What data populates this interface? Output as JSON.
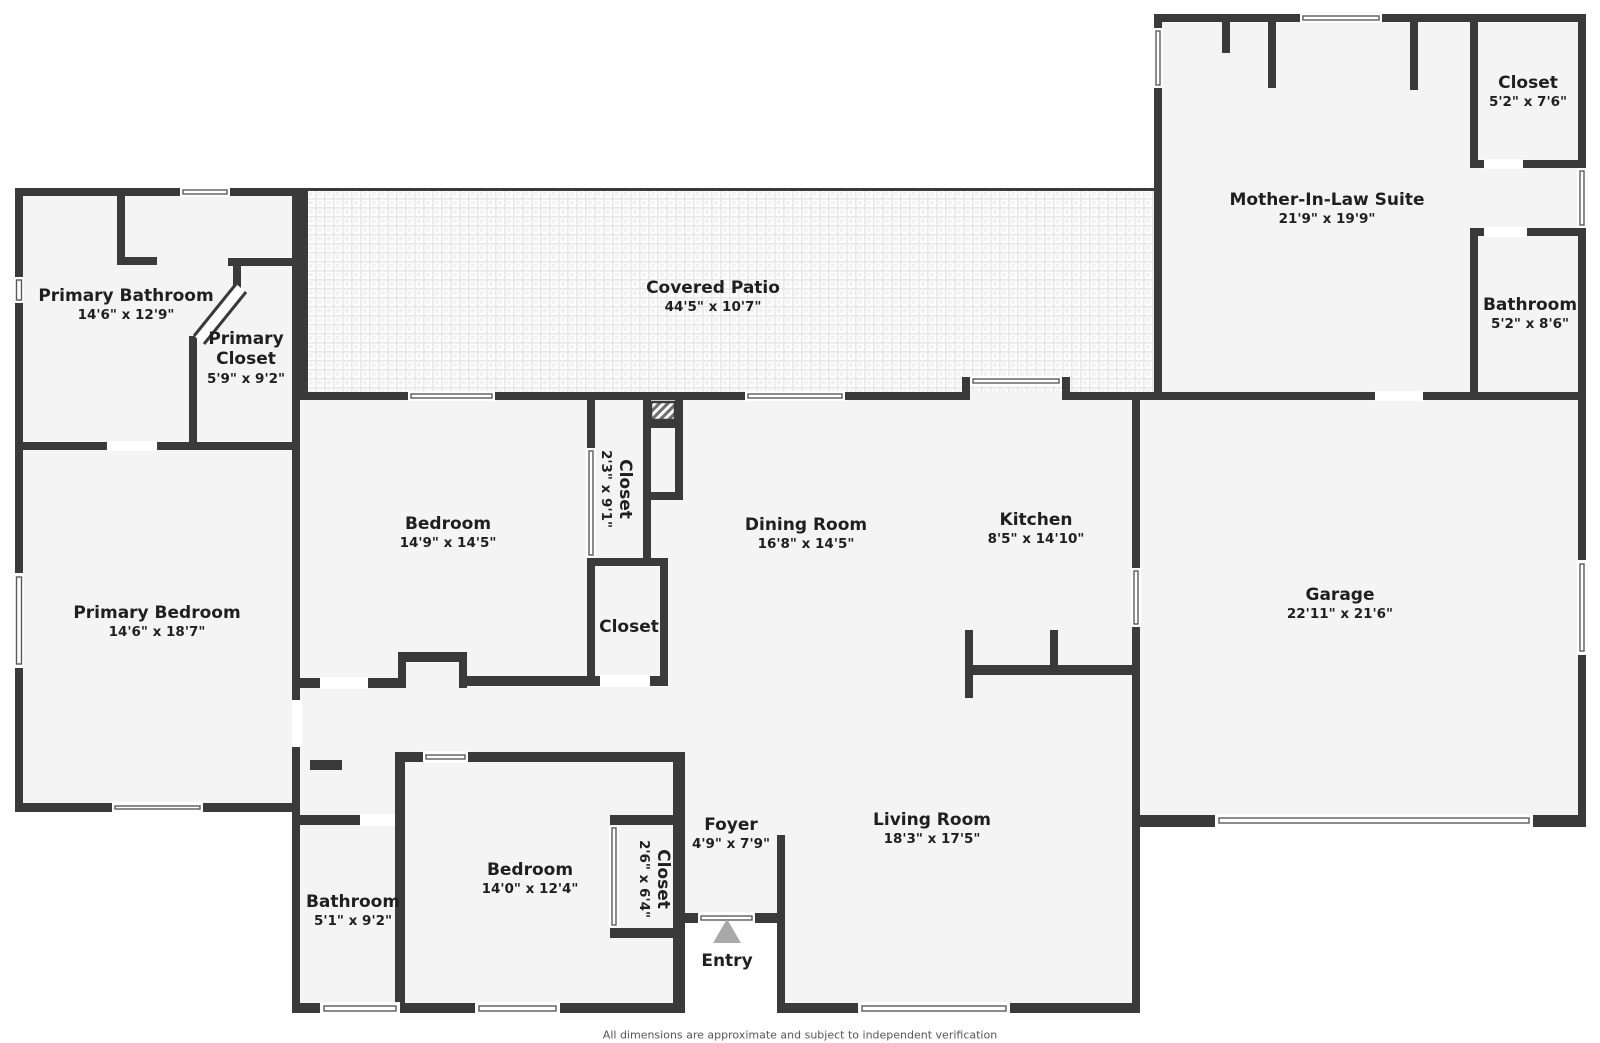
{
  "rooms": {
    "primary_bathroom": {
      "name": "Primary Bathroom",
      "dims": "14'6\" x 12'9\""
    },
    "primary_closet": {
      "name": "Primary Closet",
      "dims": "5'9\" x 9'2\""
    },
    "primary_bedroom": {
      "name": "Primary Bedroom",
      "dims": "14'6\" x 18'7\""
    },
    "bedroom_mid": {
      "name": "Bedroom",
      "dims": "14'9\" x 14'5\""
    },
    "closet_hall": {
      "name": "Closet",
      "dims": "2'3\" x 9'1\""
    },
    "closet_mid": {
      "name": "Closet"
    },
    "dining_room": {
      "name": "Dining Room",
      "dims": "16'8\" x 14'5\""
    },
    "kitchen": {
      "name": "Kitchen",
      "dims": "8'5\" x 14'10\""
    },
    "covered_patio": {
      "name": "Covered Patio",
      "dims": "44'5\" x 10'7\""
    },
    "mil_suite": {
      "name": "Mother-In-Law Suite",
      "dims": "21'9\" x 19'9\""
    },
    "mil_closet": {
      "name": "Closet",
      "dims": "5'2\" x 7'6\""
    },
    "mil_bathroom": {
      "name": "Bathroom",
      "dims": "5'2\" x 8'6\""
    },
    "garage": {
      "name": "Garage",
      "dims": "22'11\" x 21'6\""
    },
    "living_room": {
      "name": "Living Room",
      "dims": "18'3\" x 17'5\""
    },
    "foyer": {
      "name": "Foyer",
      "dims": "4'9\" x 7'9\""
    },
    "entry": {
      "name": "Entry"
    },
    "bedroom_bottom": {
      "name": "Bedroom",
      "dims": "14'0\" x 12'4\""
    },
    "bathroom_bottom": {
      "name": "Bathroom",
      "dims": "5'1\" x 9'2\""
    },
    "closet_bottom": {
      "name": "Closet",
      "dims": "2'6\" x 6'4\""
    }
  },
  "icons": {
    "entry_marker": "triangle-up-icon",
    "utility_box": "hatched-box-icon"
  },
  "footer": {
    "disclaimer": "All dimensions are approximate and subject to independent verification"
  },
  "colors": {
    "wall": "#3a3a3a",
    "room_fill": "#f4f4f4",
    "outside": "#ffffff",
    "entry_arrow": "#a9a9a9",
    "text": "#1f1f1f",
    "disclaimer_text": "#555555"
  }
}
